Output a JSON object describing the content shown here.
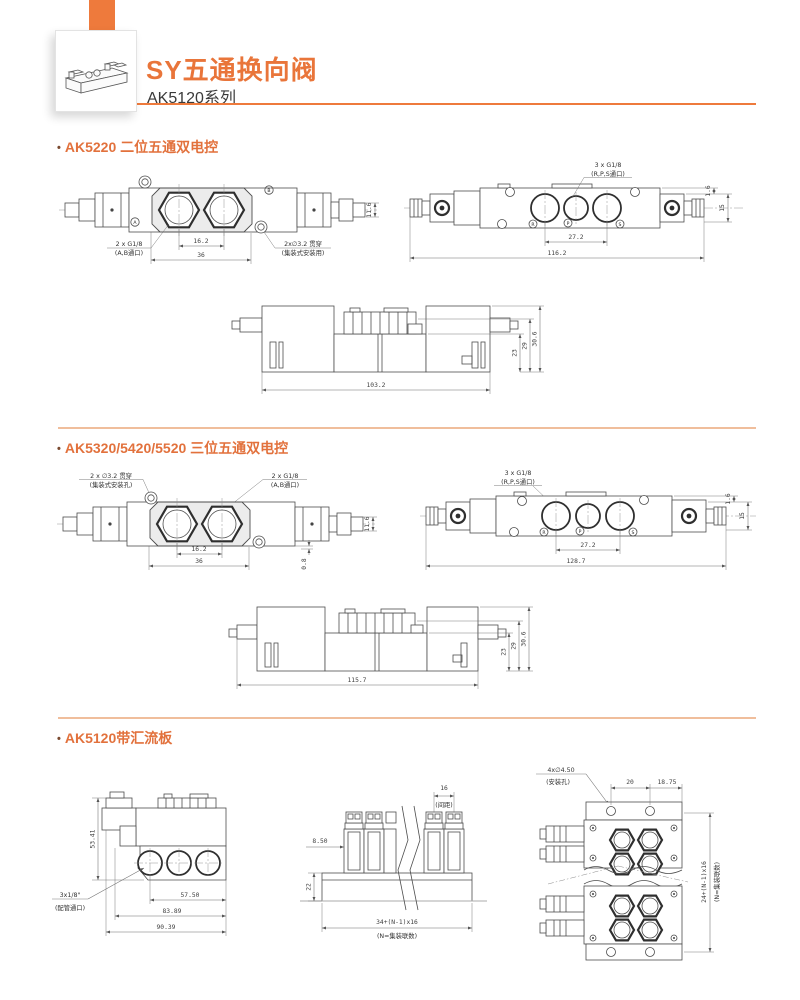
{
  "header": {
    "title": "SY五通换向阀",
    "subtitle": "AK5120系列"
  },
  "sections": {
    "s1": {
      "bullet": "•",
      "title": "AK5220 二位五通双电控"
    },
    "s2": {
      "bullet": "•",
      "title": "AK5320/5420/5520 三位五通双电控"
    },
    "s3": {
      "bullet": "•",
      "title": "AK5120带汇流板"
    }
  },
  "d1a": {
    "port_label1": "2 x G1/8",
    "port_label2": "(A,B通口)",
    "hole_label1": "2x∅3.2 贯穿",
    "hole_label2": "(集装式安装用)",
    "dim_pitch": "16.2",
    "dim_width": "36",
    "dim_height": "11.6",
    "pa": "A",
    "pb": "B"
  },
  "d1b": {
    "port_label1": "3 x G1/8",
    "port_label2": "(R,P,S通口)",
    "dim_pitch": "27.2",
    "dim_length": "116.2",
    "dim_e": "1.6",
    "dim_h": "15",
    "pr": "R",
    "pp": "P",
    "ps": "S"
  },
  "d1c": {
    "dim_length": "103.2",
    "h1": "23",
    "h2": "29",
    "h3": "30.6"
  },
  "d2a": {
    "hole_label1": "2 x ∅3.2 贯穿",
    "hole_label2": "(集装式安装孔)",
    "port_label1": "2 x G1/8",
    "port_label2": "(A,B通口)",
    "dim_pitch": "16.2",
    "dim_width": "36",
    "dim_height": "11.6",
    "dim_e": "0.8"
  },
  "d2b": {
    "port_label1": "3 x G1/8",
    "port_label2": "(R,P,S通口)",
    "dim_pitch": "27.2",
    "dim_length": "128.7",
    "dim_e": "1.6",
    "dim_h": "15",
    "pr": "R",
    "pp": "P",
    "ps": "S"
  },
  "d2c": {
    "dim_length": "115.7",
    "h1": "23",
    "h2": "29",
    "h3": "30.6"
  },
  "d3a": {
    "dim_height": "53.41",
    "port_label1": "3x1/8\"",
    "port_label2": "(配管通口)",
    "w1": "57.50",
    "w2": "83.89",
    "w3": "90.39"
  },
  "d3b": {
    "dim_pitch": "16",
    "pitch_note": "(间距)",
    "dim_offset": "8.50",
    "dim_h": "22",
    "dim_len": "34+(N-1)x16",
    "len_note": "(N=集装联数)"
  },
  "d3c": {
    "hole_label1": "4x∅4.50",
    "hole_label2": "(安装孔)",
    "dim_a": "20",
    "dim_b": "18.75",
    "dim_v": "24+(N-1)x16",
    "v_note": "(N=集装联数)"
  }
}
